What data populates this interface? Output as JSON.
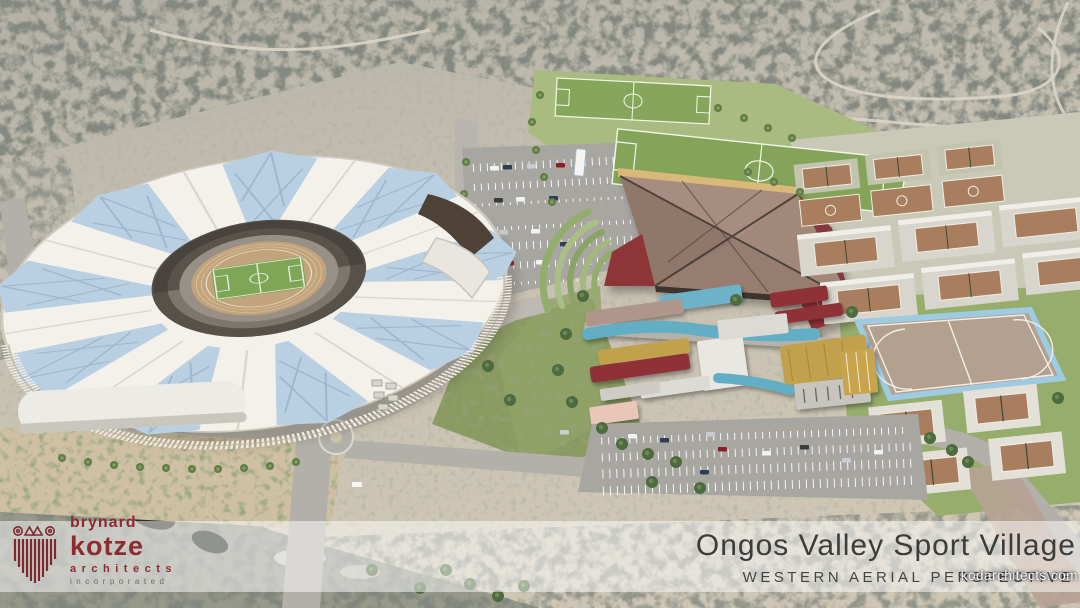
{
  "meta": {
    "width_px": 1080,
    "height_px": 608,
    "kind": "architectural-aerial-render"
  },
  "branding": {
    "logo": {
      "icon": "column-logo-icon",
      "line1": "brynard",
      "line2": "kotze",
      "line3": "architects",
      "line4": "incorporated",
      "color_primary": "#8e2b31",
      "color_secondary": "#6f6a62"
    }
  },
  "title_block": {
    "project_title": "Ongos Valley Sport Village",
    "view_label": "WESTERN AERIAL PERSPECTIVE",
    "text_color": "#3c3c3a",
    "band_color": "rgba(255,255,255,0.5)"
  },
  "watermark": {
    "text": "kodarchitects.com"
  },
  "scene": {
    "features": [
      "athletics-stadium-with-petal-roof",
      "running-track",
      "stadium-pitch",
      "soccer-field-upper",
      "soccer-field-lower",
      "grass-terraces",
      "indoor-sports-hall",
      "tennis-courts-north",
      "basketball-courts",
      "covered-court-platforms",
      "hockey-field",
      "tennis-courts-south",
      "clubhouse-cluster",
      "parking-lot-north",
      "parking-lot-south",
      "roundabout",
      "access-roads",
      "desert-scrub-terrain",
      "ravine"
    ],
    "palette": {
      "terrain": "#c2bcae",
      "scrub": "#3f443c",
      "lawn": "#97ad6e",
      "pitch_green": "#7fa557",
      "track_tan": "#c2a47c",
      "roof_white": "#f3f1ea",
      "roof_glass": "#b9cfe2",
      "hall_roof": "#9b8174",
      "accent_maroon": "#8e3038",
      "accent_gold": "#c2a14d",
      "accent_teal": "#62aec5",
      "court_clay": "#a87e5e",
      "hockey_border": "#9fcbe2",
      "road": "#b3b0aa",
      "parking": "#a8a6a1"
    }
  }
}
